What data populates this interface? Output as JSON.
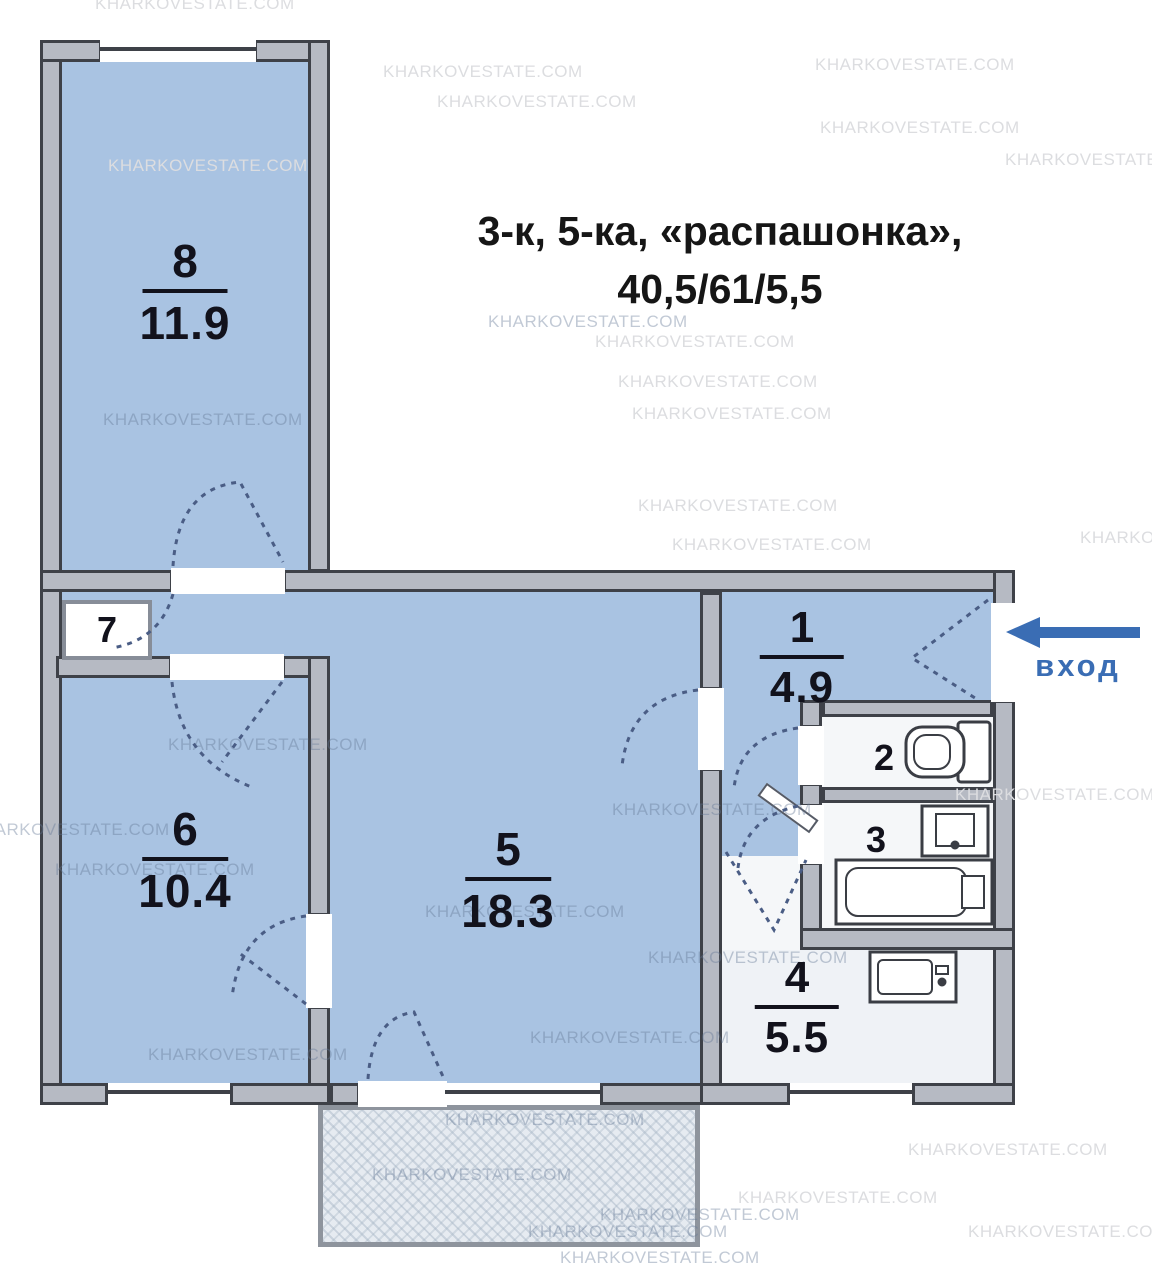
{
  "title": {
    "line1": "3-к, 5-ка, «распашонка»,",
    "line2": "40,5/61/5,5"
  },
  "watermark": {
    "text": "KHARKOVESTATE.COM"
  },
  "entrance": {
    "label": "вход",
    "arrow_color": "#3a6db4"
  },
  "rooms": {
    "r8": {
      "num": "8",
      "area": "11.9"
    },
    "r7": {
      "num": "7"
    },
    "r6": {
      "num": "6",
      "area": "10.4"
    },
    "r5": {
      "num": "5",
      "area": "18.3"
    },
    "r1": {
      "num": "1",
      "area": "4.9"
    },
    "r2": {
      "num": "2"
    },
    "r3": {
      "num": "3"
    },
    "r4": {
      "num": "4",
      "area": "5.5"
    }
  },
  "colors": {
    "room_fill": "#a9c3e2",
    "wall_fill": "#b6bac3",
    "wall_line": "#3e4148",
    "label_text": "#12121c",
    "entrance_blue": "#3a6db4",
    "balcony_fill": "#e6ebf1"
  }
}
